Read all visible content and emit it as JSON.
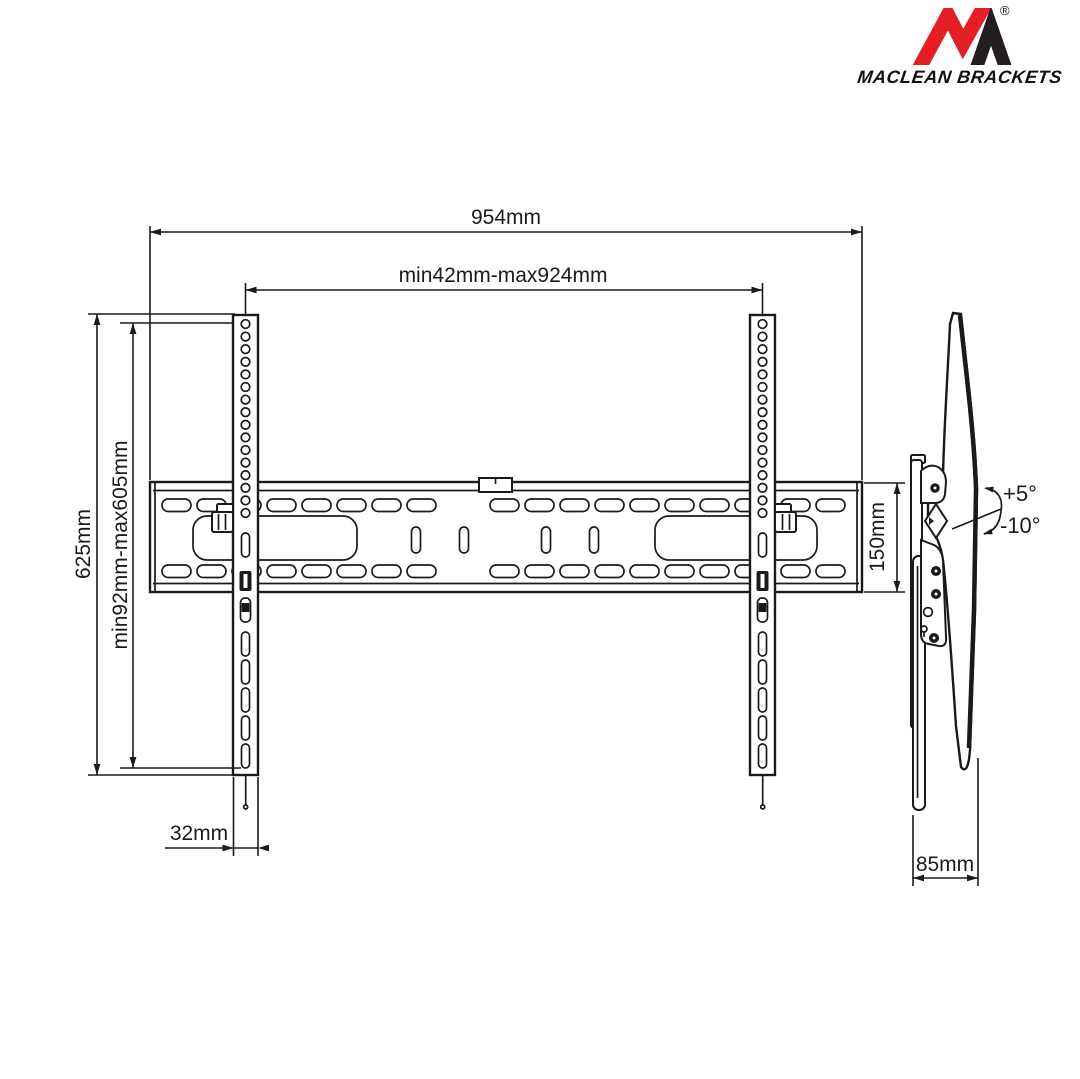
{
  "brand": {
    "wordmark": "MACLEAN BRACKETS",
    "registered_mark": "®",
    "colors": {
      "logo_red": "#e31e24",
      "logo_dark": "#231f20"
    }
  },
  "drawing": {
    "line_color": "#1a1a1a",
    "background": "#ffffff",
    "dimensions": {
      "total_width": "954mm",
      "hole_pattern_width_range": "min42mm-max924mm",
      "total_height": "625mm",
      "hole_pattern_height_range": "min92mm-max605mm",
      "wall_rail_height": "150mm",
      "vesa_arm_width": "32mm",
      "profile_depth": "85mm",
      "tilt_up_angle": "+5°",
      "tilt_down_angle": "-10°"
    }
  }
}
